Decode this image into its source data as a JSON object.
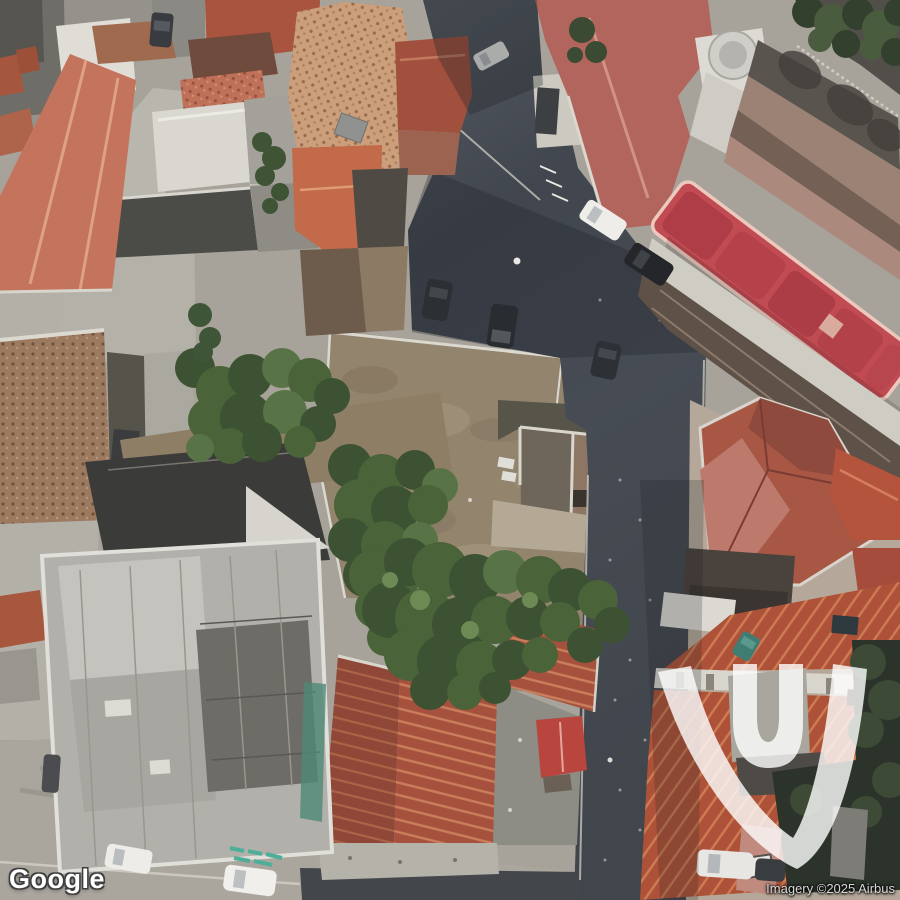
{
  "map": {
    "alt": "Satellite aerial view of a dense Mediterranean town block with terracotta tiled roofs, a large concrete rooftop, an overgrown vacant courtyard, narrow shadowed asphalt streets and parked cars"
  },
  "branding": {
    "logo_text": "Google"
  },
  "attribution": {
    "credit": "Imagery ©2025 Airbus"
  },
  "watermark": {
    "name": "vu-monogram",
    "color": "#ffffff",
    "opacity": 0.8
  },
  "palette": {
    "asphalt": "#474c54",
    "asphalt_dark": "#3d424a",
    "pavement": "#b3b0a8",
    "terracotta_light": "#cb9e7c",
    "roof_salmon": "#bf7058",
    "roof_red": "#b2655c",
    "awning_red": "#c14b52",
    "roof_orange": "#ad5238",
    "vegetation": "#49613b",
    "concrete": "#b2b0aa",
    "dirt": "#93846e"
  }
}
